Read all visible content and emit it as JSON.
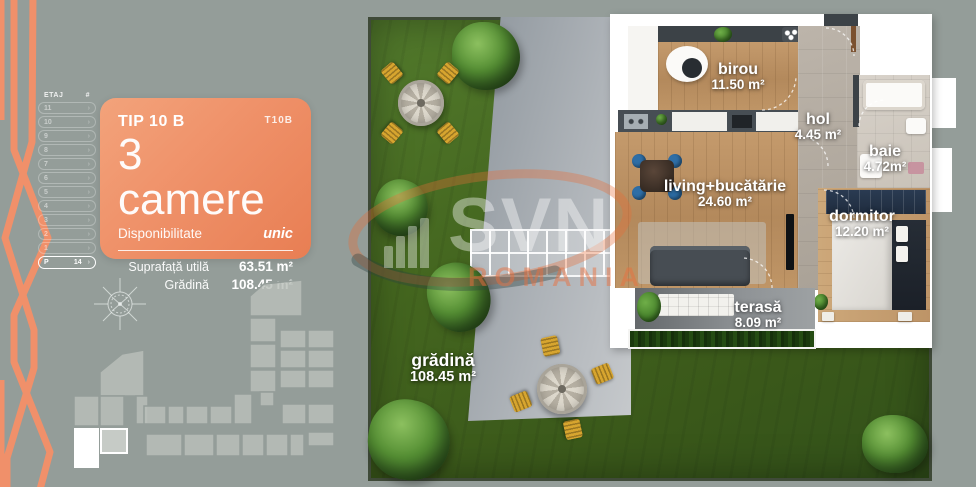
{
  "background_color": "#949d99",
  "accent_orange": "#ee8b60",
  "icons": {
    "chevron": "›",
    "compass": "compass-rose",
    "building": "building-site-map"
  },
  "sidebar": {
    "header": {
      "etaj": "ETAJ",
      "hash": "#"
    },
    "floors": [
      {
        "label": "11"
      },
      {
        "label": "10"
      },
      {
        "label": "9"
      },
      {
        "label": "8"
      },
      {
        "label": "7"
      },
      {
        "label": "6"
      },
      {
        "label": "5"
      },
      {
        "label": "4"
      },
      {
        "label": "3"
      },
      {
        "label": "2"
      },
      {
        "label": "1"
      }
    ],
    "active_floor": {
      "label": "P",
      "count": "14"
    }
  },
  "card": {
    "title": "TIP 10 B",
    "code": "T10B",
    "rooms_big": "3 camere",
    "availability_label": "Disponibilitate",
    "availability_value": "unic",
    "metrics": [
      {
        "label": "Suprafață utilă",
        "value": "63.51 m²"
      },
      {
        "label": "Grădină",
        "value": "108.45 m²"
      }
    ]
  },
  "watermark": {
    "brand": "SVN",
    "sub": "ROMANIA"
  },
  "plan": {
    "rooms": [
      {
        "name": "birou",
        "area": "11.50 m²"
      },
      {
        "name": "hol",
        "area": "4.45 m²"
      },
      {
        "name": "baie",
        "area": "4.72m²"
      },
      {
        "name": "living+bucătărie",
        "area": "24.60 m²"
      },
      {
        "name": "dormitor",
        "area": "12.20 m²"
      },
      {
        "name": "terasă",
        "area": "8.09 m²"
      },
      {
        "name": "grădină",
        "area": "108.45 m²"
      }
    ]
  }
}
